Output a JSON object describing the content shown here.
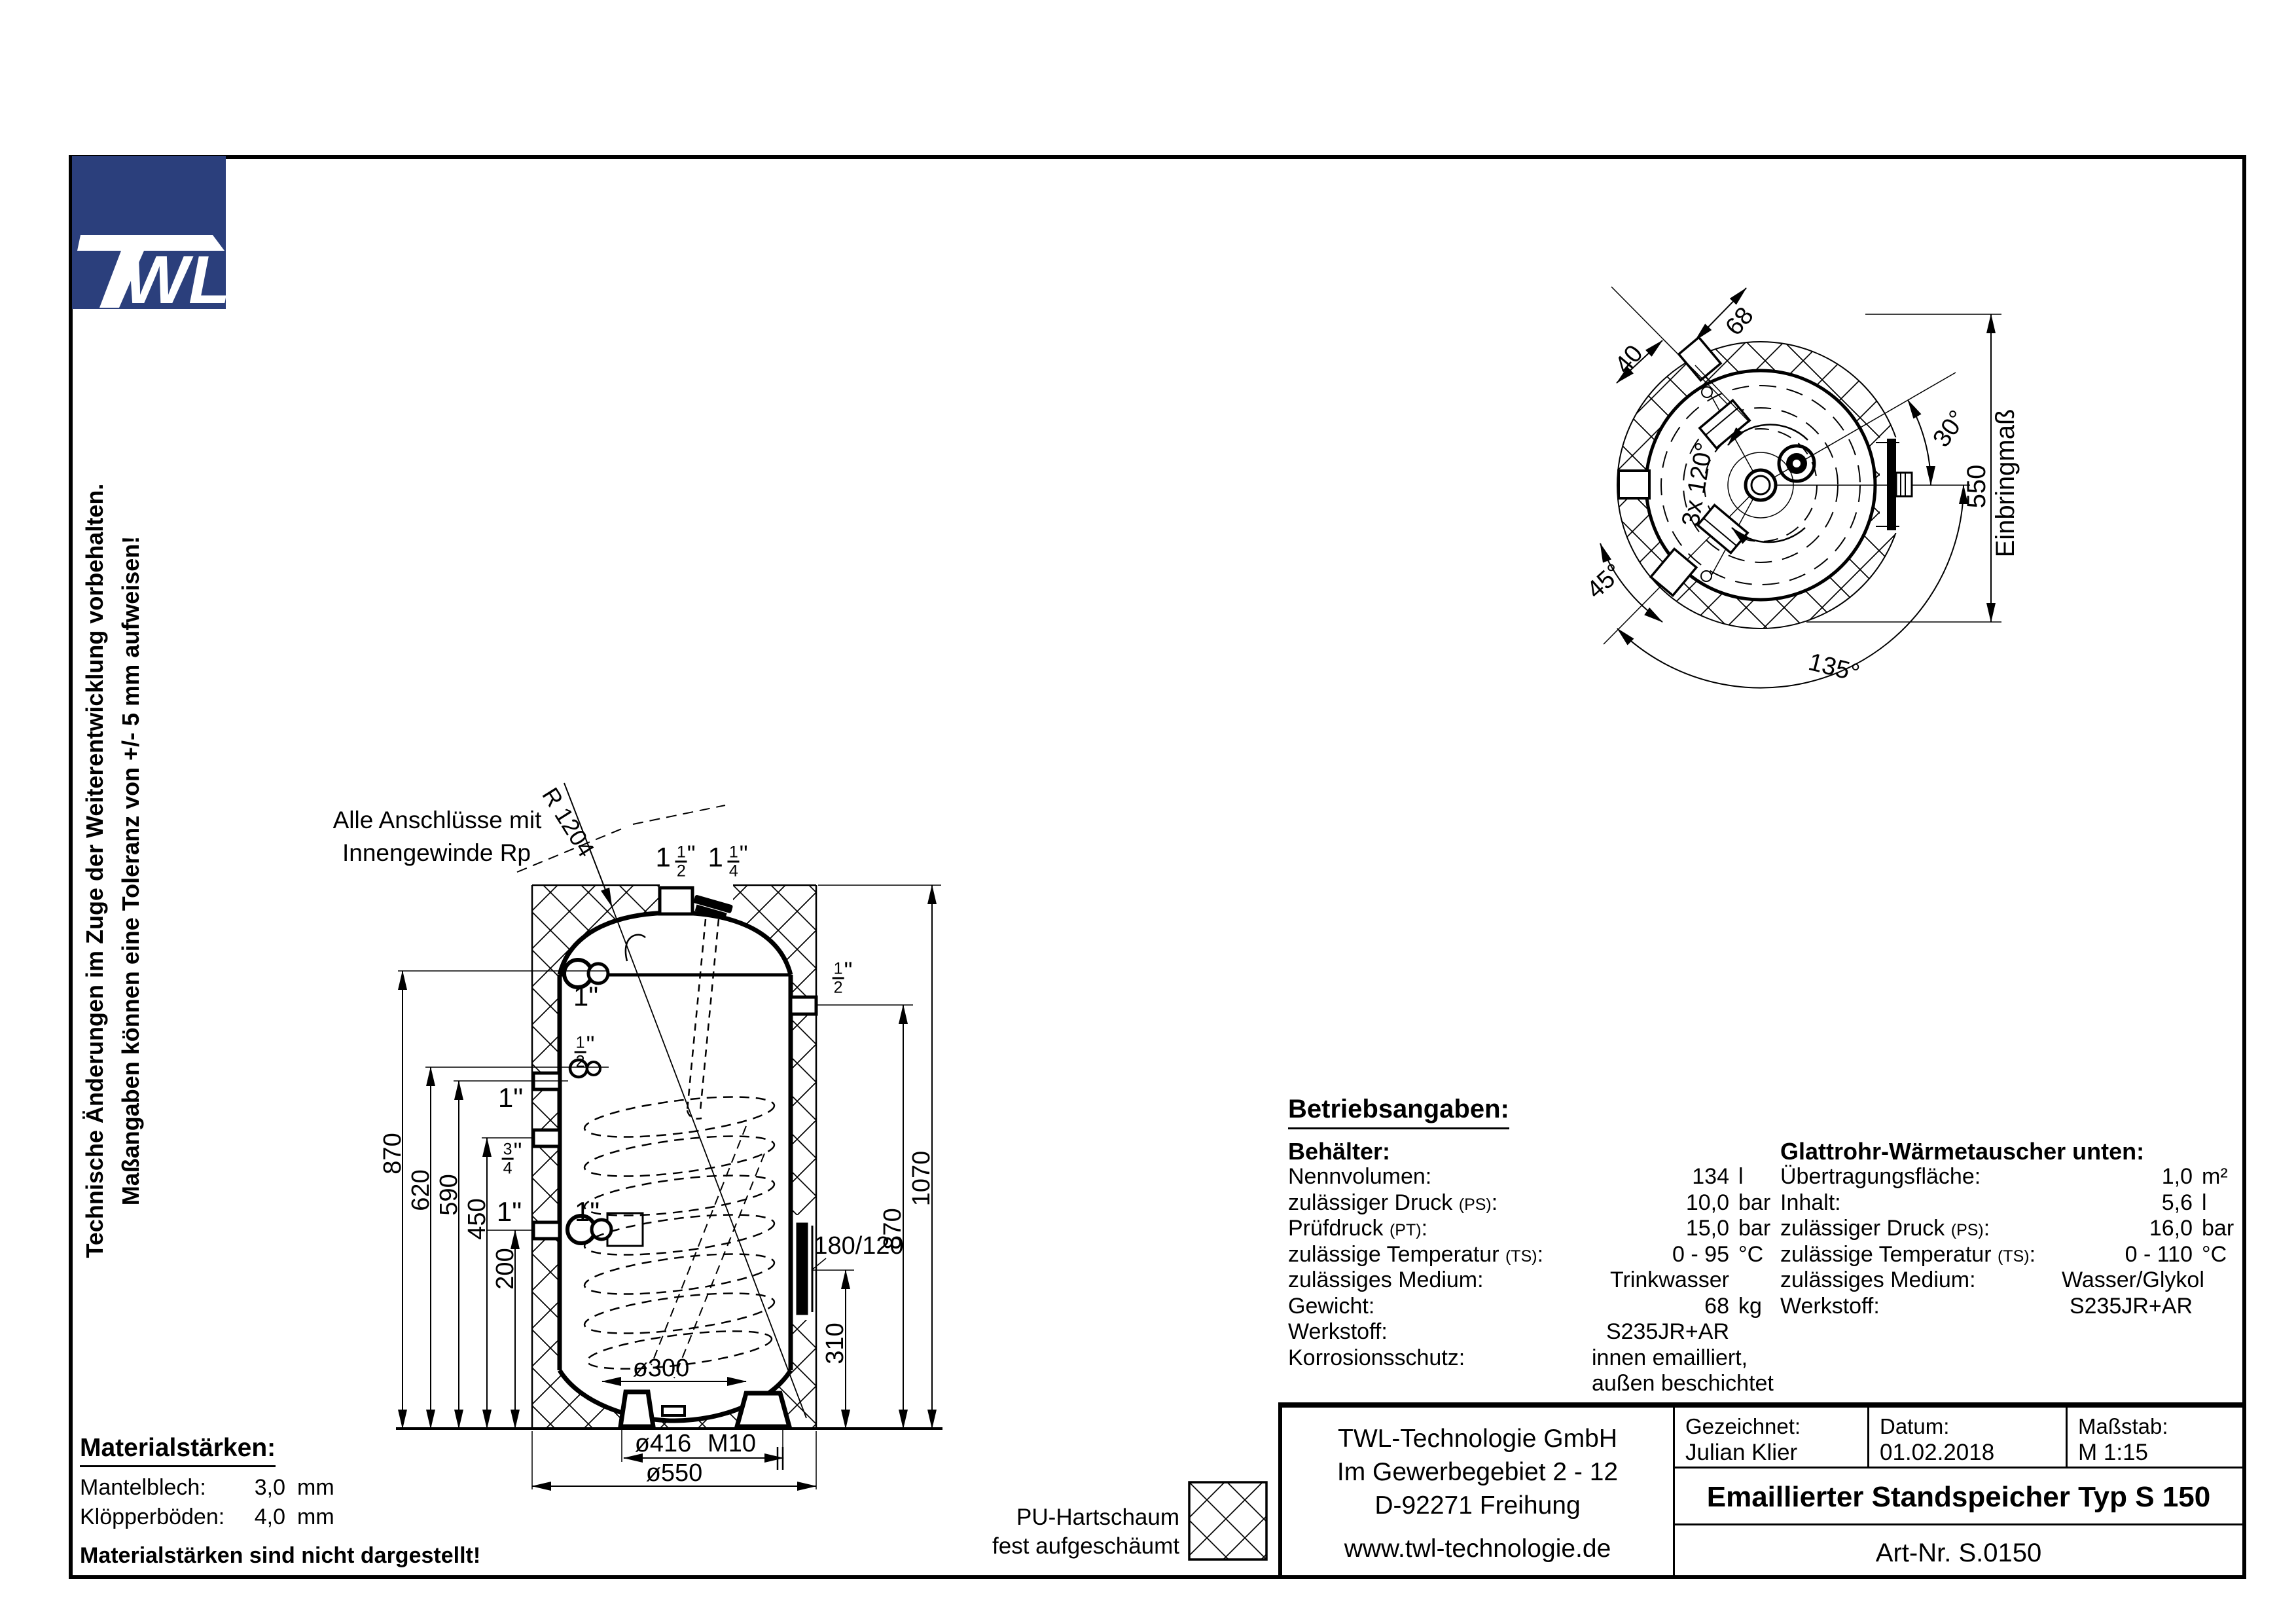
{
  "side_note": {
    "line1": "Technische Änderungen im Zuge der Weiterentwicklung vorbehalten.",
    "line2": "Maßangaben können eine Toleranz von +/- 5 mm aufweisen!"
  },
  "logo": {
    "text_w": "W",
    "text_l": "L",
    "color": "#2b3f7c"
  },
  "front_view": {
    "note1": "Alle Anschlüsse mit",
    "note2": "Innengewinde Rp",
    "radius": "R 1204",
    "dim_870_left": "870",
    "dim_620": "620",
    "dim_590": "590",
    "dim_450": "450",
    "dim_200": "200",
    "dim_1070": "1070",
    "dim_870_right": "870",
    "dim_310": "310",
    "dim_flange": "180/120",
    "dim_d300": "ø300",
    "dim_d416": "ø416",
    "dim_m10": "M10",
    "dim_d550": "ø550",
    "conn_1_top": "1\"",
    "conn_1_mid": "1\"",
    "conn_1_bot_left": "1\"",
    "conn_1_bot_right": "1\"",
    "frac_1half": {
      "whole": "1",
      "num": "1",
      "den": "2",
      "unit": "\""
    },
    "frac_1quarter": {
      "whole": "1",
      "num": "1",
      "den": "4",
      "unit": "\""
    },
    "frac_half_right": {
      "whole": "",
      "num": "1",
      "den": "2",
      "unit": "\""
    },
    "frac_half_left": {
      "whole": "",
      "num": "1",
      "den": "2",
      "unit": "\""
    },
    "frac_34_left": {
      "whole": "",
      "num": "3",
      "den": "4",
      "unit": "\""
    }
  },
  "top_view": {
    "dim_68": "68",
    "dim_40": "40",
    "ang_30": "30°",
    "dim_550": "550",
    "einbring": "Einbringmaß",
    "ang_3x120": "3x 120°",
    "ang_45": "45°",
    "ang_135": "135°"
  },
  "betriebsangaben": {
    "title": "Betriebsangaben:",
    "behaelter_title": "Behälter:",
    "behaelter_rows": [
      {
        "label": "Nennvolumen:",
        "sub": "",
        "post": "",
        "value": "134",
        "unit": "l"
      },
      {
        "label": "zulässiger Druck ",
        "sub": "(PS)",
        "post": ":",
        "value": "10,0",
        "unit": "bar"
      },
      {
        "label": "Prüfdruck ",
        "sub": "(PT)",
        "post": ":",
        "value": "15,0",
        "unit": "bar"
      },
      {
        "label": "zulässige Temperatur ",
        "sub": "(TS)",
        "post": ":",
        "value": "0 - 95",
        "unit": "°C"
      },
      {
        "label": "zulässiges Medium:",
        "sub": "",
        "post": "",
        "value": "Trinkwasser",
        "unit": ""
      },
      {
        "label": "Gewicht:",
        "sub": "",
        "post": "",
        "value": "68",
        "unit": "kg"
      },
      {
        "label": "Werkstoff:",
        "sub": "",
        "post": "",
        "value": "S235JR+AR",
        "unit": ""
      },
      {
        "label": "Korrosionsschutz:",
        "sub": "",
        "post": "",
        "value": "innen emailliert,",
        "unit": ""
      },
      {
        "label": "",
        "sub": "",
        "post": "",
        "value": "außen beschichtet",
        "unit": ""
      }
    ],
    "wt_title": "Glattrohr-Wärmetauscher ",
    "wt_title_sub": "unten",
    "wt_title_post": ":",
    "wt_rows": [
      {
        "label": "Übertragungsfläche:",
        "sub": "",
        "post": "",
        "value": "1,0",
        "unit": "m²"
      },
      {
        "label": "Inhalt:",
        "sub": "",
        "post": "",
        "value": "5,6",
        "unit": "l"
      },
      {
        "label": "zulässiger Druck ",
        "sub": "(PS)",
        "post": ":",
        "value": "16,0",
        "unit": "bar"
      },
      {
        "label": "zulässige Temperatur ",
        "sub": "(TS)",
        "post": ":",
        "value": "0 - 110",
        "unit": "°C"
      },
      {
        "label": "zulässiges Medium:",
        "sub": "",
        "post": "",
        "value": "Wasser/Glykol",
        "unit": ""
      },
      {
        "label": "Werkstoff:",
        "sub": "",
        "post": "",
        "value": "S235JR+AR",
        "unit": ""
      }
    ]
  },
  "material": {
    "title": "Materialstärken:",
    "rows": [
      {
        "label": "Mantelblech:",
        "value": "3,0",
        "unit": "mm"
      },
      {
        "label": "Klöpperböden:",
        "value": "4,0",
        "unit": "mm"
      }
    ],
    "note": "Materialstärken sind nicht dargestellt!"
  },
  "legend": {
    "line1": "PU-Hartschaum",
    "line2": "fest aufgeschäumt"
  },
  "titleblock": {
    "company_line1": "TWL-Technologie GmbH",
    "company_line2": "Im Gewerbegebiet 2 - 12",
    "company_line3": "D-92271 Freihung",
    "website": "www.twl-technologie.de",
    "drawn_label": "Gezeichnet:",
    "drawn_value": "Julian Klier",
    "date_label": "Datum:",
    "date_value": "01.02.2018",
    "scale_label": "Maßstab:",
    "scale_value": "M 1:15",
    "drawing_title": "Emaillierter Standspeicher Typ S 150",
    "art_nr": "Art-Nr. S.0150"
  }
}
